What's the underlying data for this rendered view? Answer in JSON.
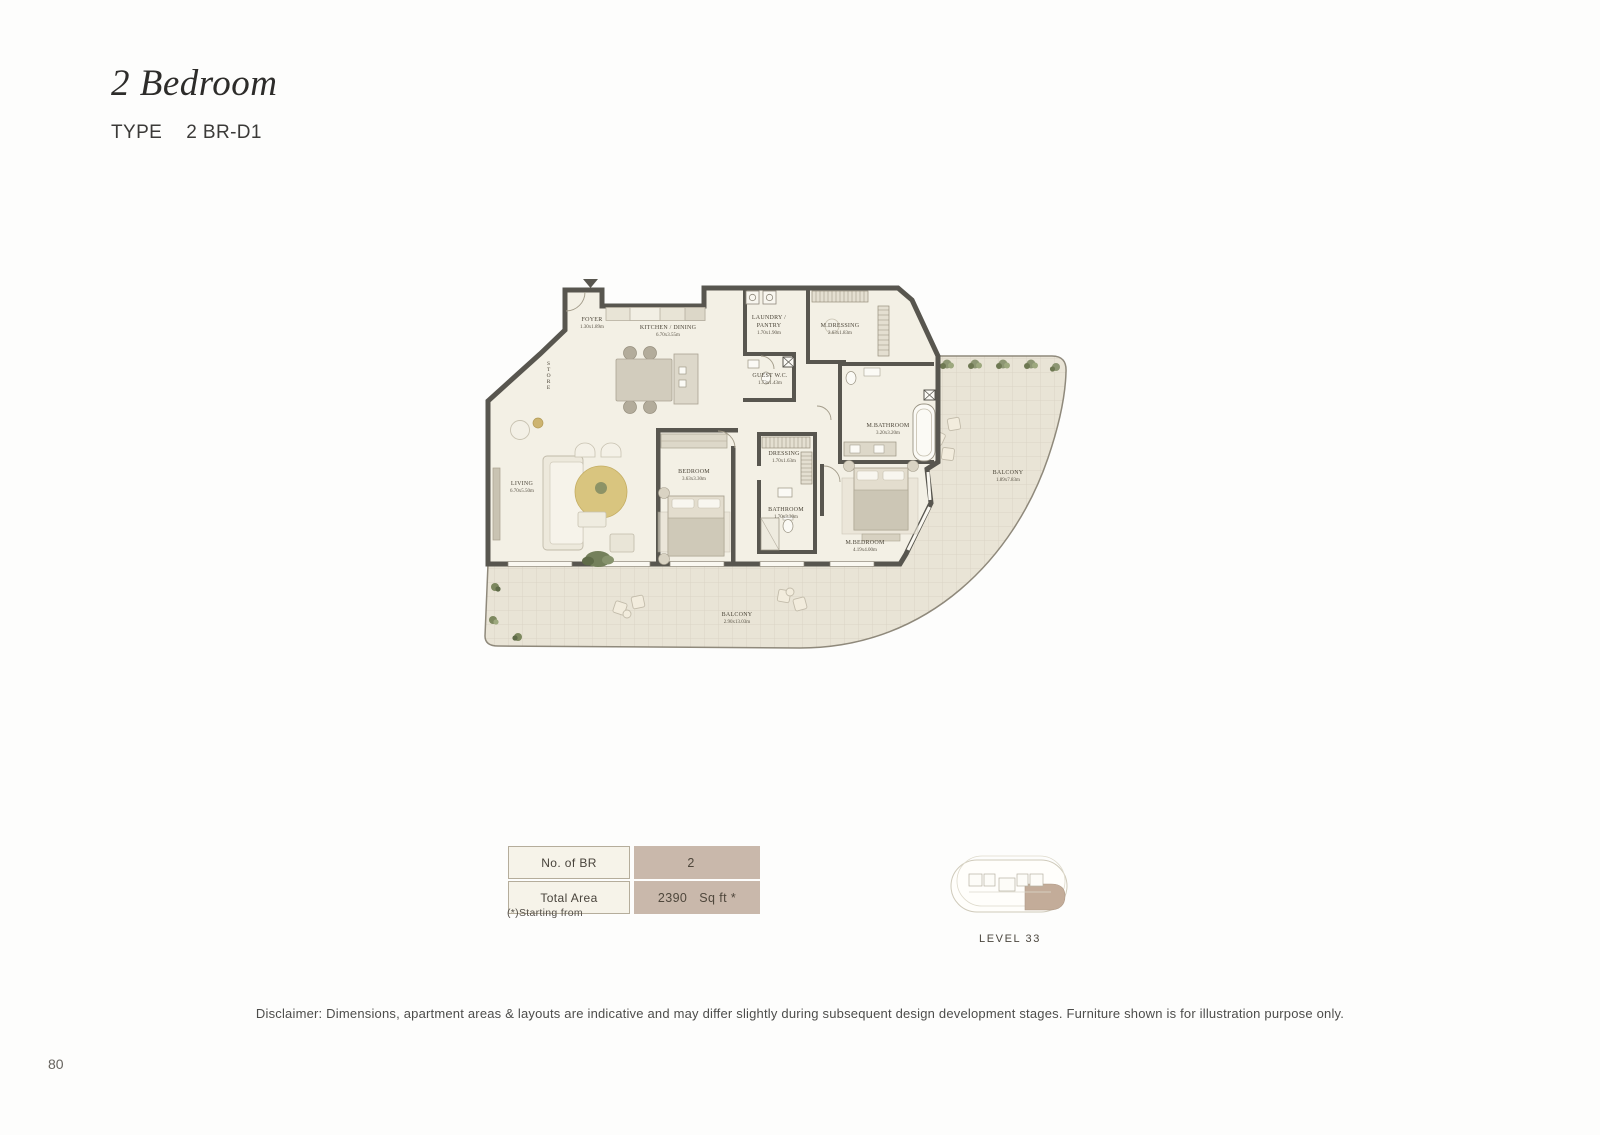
{
  "page": {
    "title": "2 Bedroom",
    "type_label": "TYPE",
    "type_value": "2 BR-D1",
    "page_number": "80",
    "disclaimer": "Disclaimer: Dimensions, apartment areas & layouts are indicative and may differ slightly during subsequent design development stages. Furniture shown is for illustration purpose only."
  },
  "floorplan": {
    "rooms": [
      {
        "name": "FOYER",
        "dims": "1.30x1.89m",
        "x": 112,
        "y": 64
      },
      {
        "name": "KITCHEN / DINING",
        "dims": "6.70x3.55m",
        "x": 188,
        "y": 72
      },
      {
        "name": "LAUNDRY / PANTRY",
        "dims": "1.70x1.90m",
        "x": 289,
        "y": 66,
        "wrap": true
      },
      {
        "name": "M.DRESSING",
        "dims": "2.63x1.83m",
        "x": 360,
        "y": 70
      },
      {
        "name": "STORE",
        "dims": "",
        "x": 68,
        "y": 116,
        "vertical": true
      },
      {
        "name": "GUEST W.C.",
        "dims": "1.73x1.43m",
        "x": 290,
        "y": 120
      },
      {
        "name": "M.BATHROOM",
        "dims": "3.20x3.20m",
        "x": 408,
        "y": 170
      },
      {
        "name": "DRESSING",
        "dims": "1.70x1.63m",
        "x": 304,
        "y": 198
      },
      {
        "name": "BEDROOM",
        "dims": "3.63x3.30m",
        "x": 214,
        "y": 216
      },
      {
        "name": "BATHROOM",
        "dims": "1.70x3.30m",
        "x": 306,
        "y": 254
      },
      {
        "name": "LIVING",
        "dims": "6.70x5.50m",
        "x": 42,
        "y": 228
      },
      {
        "name": "M.BEDROOM",
        "dims": "4.19x4.00m",
        "x": 385,
        "y": 287
      },
      {
        "name": "BALCONY",
        "dims": "1.89x7.83m",
        "x": 528,
        "y": 217
      },
      {
        "name": "BALCONY",
        "dims": "2.90x13.03m",
        "x": 257,
        "y": 359
      }
    ]
  },
  "spec_table": {
    "rows": [
      {
        "label": "No. of BR",
        "value": "2",
        "unit": ""
      },
      {
        "label": "Total Area",
        "value": "2390",
        "unit": "Sq ft  *"
      }
    ],
    "footnote": "(*)Starting from"
  },
  "keyplan": {
    "caption": "LEVEL 33"
  },
  "colors": {
    "wall": "#58564f",
    "floor": "#f3f0e5",
    "balcony": "#e9e4d6",
    "accent": "#c9b8ab",
    "cell": "#f6f3e9",
    "cellBorder": "#b5ad9b",
    "highlight": "#c3ac99"
  }
}
